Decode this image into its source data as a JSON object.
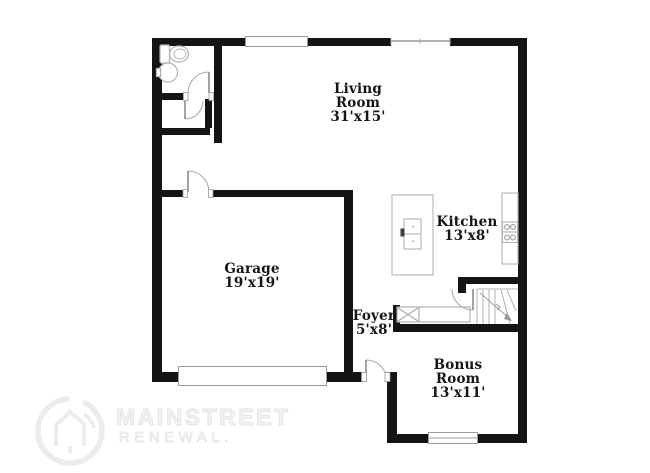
{
  "floor_plan": {
    "rooms": [
      {
        "id": "living-room",
        "name_lines": [
          "Living",
          "Room"
        ],
        "dims": "31'x15'"
      },
      {
        "id": "kitchen",
        "name_lines": [
          "Kitchen"
        ],
        "dims": "13'x8'"
      },
      {
        "id": "garage",
        "name_lines": [
          "Garage"
        ],
        "dims": "19'x19'"
      },
      {
        "id": "foyer",
        "name_lines": [
          "Foyer"
        ],
        "dims": "5'x8'"
      },
      {
        "id": "bonus-room",
        "name_lines": [
          "Bonus",
          "Room"
        ],
        "dims": "13'x11'"
      }
    ],
    "fixture_icons": [
      "toilet-icon",
      "sink-icon",
      "kitchen-island",
      "island-sink-icon",
      "range-stove-icon",
      "stairs-icon",
      "appliance-box-icon",
      "garage-door",
      "window",
      "door-swing"
    ]
  },
  "watermark": {
    "brand": "MAINSTREET",
    "tagline": "RENEWAL."
  },
  "colors": {
    "wall": "#141414",
    "fixture_outline": "#b0b0b0",
    "label_text": "#151515",
    "watermark": "#e8eaea"
  }
}
